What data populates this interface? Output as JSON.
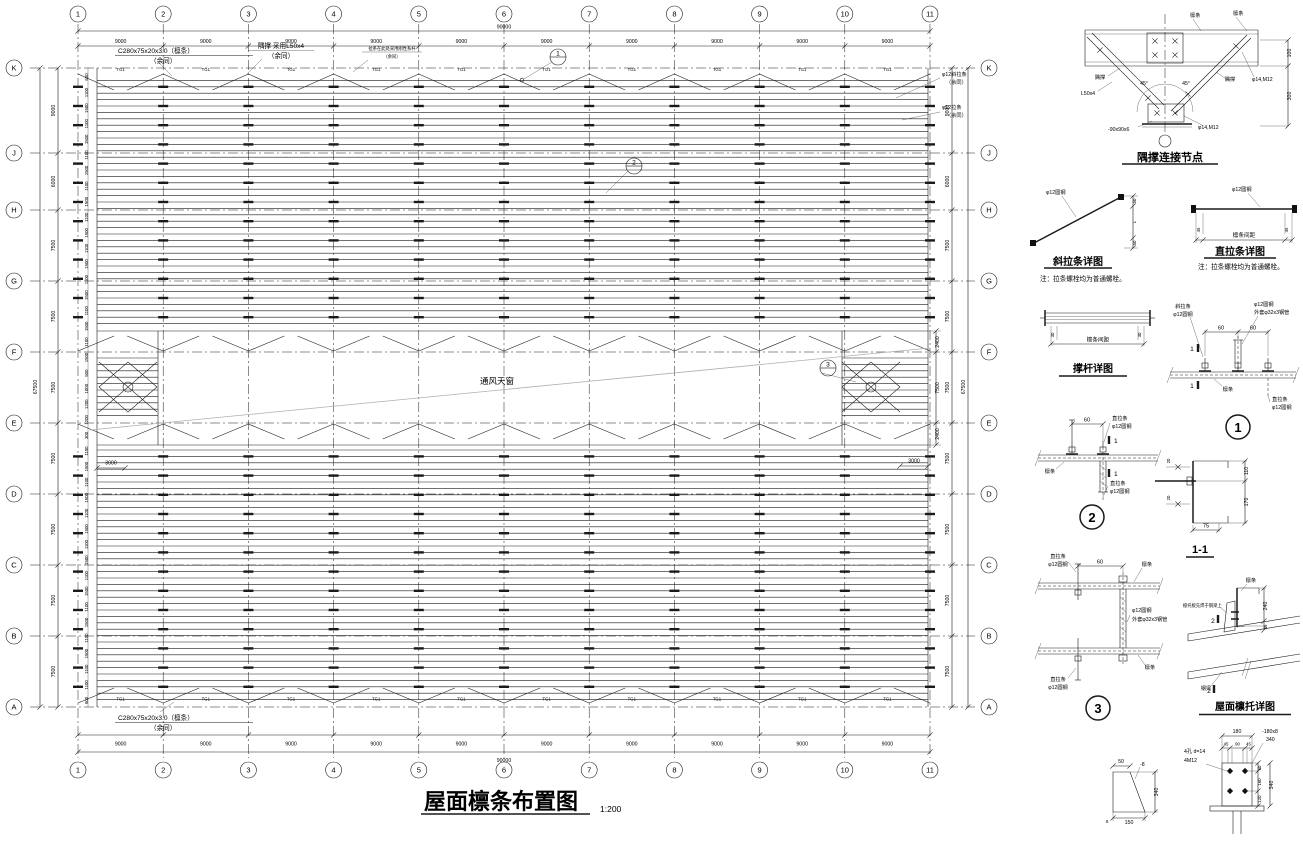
{
  "drawing": {
    "title": "屋面檩条布置图",
    "scale": "1:200",
    "plan": {
      "col_axes": [
        "1",
        "2",
        "3",
        "4",
        "5",
        "6",
        "7",
        "8",
        "9",
        "10",
        "11"
      ],
      "col_bay_dim": "9000",
      "col_total_dim": "90000",
      "row_axes": [
        "K",
        "J",
        "H",
        "G",
        "F",
        "E",
        "D",
        "C",
        "B",
        "A"
      ],
      "row_dims": [
        "9000",
        "6000",
        "7500",
        "7500",
        "7500",
        "7500",
        "7500",
        "7500",
        "7500"
      ],
      "row_total_dim": "67500",
      "purlin_dims": [
        "600",
        "1100",
        "1500",
        "1100",
        "1500",
        "1100",
        "1500",
        "1100",
        "1500",
        "1100",
        "1500",
        "1100",
        "1500",
        "1100",
        "1500",
        "1100",
        "1500",
        "1100",
        "1500",
        "500",
        "1000",
        "1200",
        "1200",
        "300",
        "1100",
        "1500",
        "1100",
        "1500",
        "1100",
        "1500",
        "1100",
        "1500",
        "1100",
        "1500",
        "1100",
        "1500",
        "1100",
        "1500",
        "1100",
        "1100",
        "600"
      ],
      "skylight_dims": [
        "2400",
        "7500",
        "2400"
      ],
      "skylight_end_dim": "3000",
      "tie_label": "TG1",
      "callouts": [
        "1",
        "2",
        "3"
      ],
      "notes": {
        "purlin_note_1": "C280x75x20x3.0（檩条）",
        "purlin_note_2": "（余同）",
        "brace_note_1": "隅撑 采用L50x4",
        "brace_note_2": "（余同）",
        "ridge_note_1": "拉条在此处采用刚性系杆",
        "ridge_note_2": "（余同）",
        "right_note1_1": "φ12斜拉条",
        "right_note1_2": "（余同）",
        "right_note2_1": "φ12拉条",
        "right_note2_2": "（余同）",
        "bottom_note_1": "C280x75x20x3.0（檩条）",
        "bottom_note_2": "（余同）",
        "skylight_label": "通风天窗"
      }
    },
    "details": {
      "d1": {
        "title": "隅撑连接节点",
        "purlin_a": "檩条",
        "purlin_b": "檩条",
        "brace_l": "隅撑",
        "brace_r": "隅撑",
        "angle_spec": "L50x4",
        "plate": "-90x90x6",
        "bolt_top": "φ14,M12",
        "bolt_bottom": "φ14,M12",
        "angle_l": "45°",
        "angle_r": "45°",
        "dim_top": "100",
        "dim_bottom": "300"
      },
      "d2": {
        "title": "斜拉条详图",
        "rod": "φ12圆钢",
        "dims": [
          "50",
          "L",
          "50"
        ],
        "note": "注：拉条螺栓均为普通螺栓。"
      },
      "d3": {
        "title": "直拉条详图",
        "rod": "φ12圆钢",
        "dim_mid": "檩条间距",
        "dim_end_l": "45",
        "dim_end_r": "45",
        "note": "注：拉条螺栓均为普通螺栓。"
      },
      "d4": {
        "title": "撑杆详图",
        "dim_mid": "檩条间距",
        "dim_end": "30"
      },
      "d5": {
        "num": "1",
        "dim_a": "60",
        "dim_b": "60",
        "diag_l1": "斜拉条",
        "diag_l2": "φ12圆钢",
        "tube_l1": "φ12圆钢",
        "tube_l2": "外套φ32x3钢管",
        "purlin": "檩条",
        "tie_l1": "直拉条",
        "tie_l2": "φ12圆钢",
        "sec": "1"
      },
      "d6": {
        "num": "2",
        "dim": "60",
        "tie_t1": "直拉条",
        "tie_t2": "φ12圆钢",
        "purlin": "檩条",
        "tie_b1": "直拉条",
        "tie_b2": "φ12圆钢",
        "sec": "1"
      },
      "d7": {
        "title": "1-1",
        "dim_top": "110",
        "dim_bottom": "170",
        "dim_width": "75",
        "dim_small": "20"
      },
      "d8": {
        "num": "3",
        "dim": "60",
        "tie_t1": "直拉条",
        "tie_t2": "φ12圆钢",
        "purlin_t": "檩条",
        "tube_1": "φ12圆钢",
        "tube_2": "外套φ32x3钢管",
        "purlin_b": "檩条",
        "tie_b1": "直拉条",
        "tie_b2": "φ12圆钢"
      },
      "d9": {
        "title": "屋面檩托详图",
        "purlin": "檩条",
        "note": "檩托板先焊于钢梁上",
        "beam": "钢梁",
        "sec": "2",
        "dim_a": "240",
        "dim_b": "45"
      },
      "d10": {
        "dim_top": "50",
        "plate": "-8",
        "dim_side": "340",
        "dim_weld": "8",
        "dim_bottom": "150"
      },
      "d11": {
        "dim_total": "180",
        "dim_sub": [
          "45",
          "90",
          "45"
        ],
        "holes_1": "4孔 d=14",
        "holes_2": "4M12",
        "plate_1": "-180x8",
        "plate_2": "340",
        "dim_r1": "60",
        "dim_r2": "160",
        "dim_r3": "120",
        "dim_r_total": "340"
      }
    }
  }
}
